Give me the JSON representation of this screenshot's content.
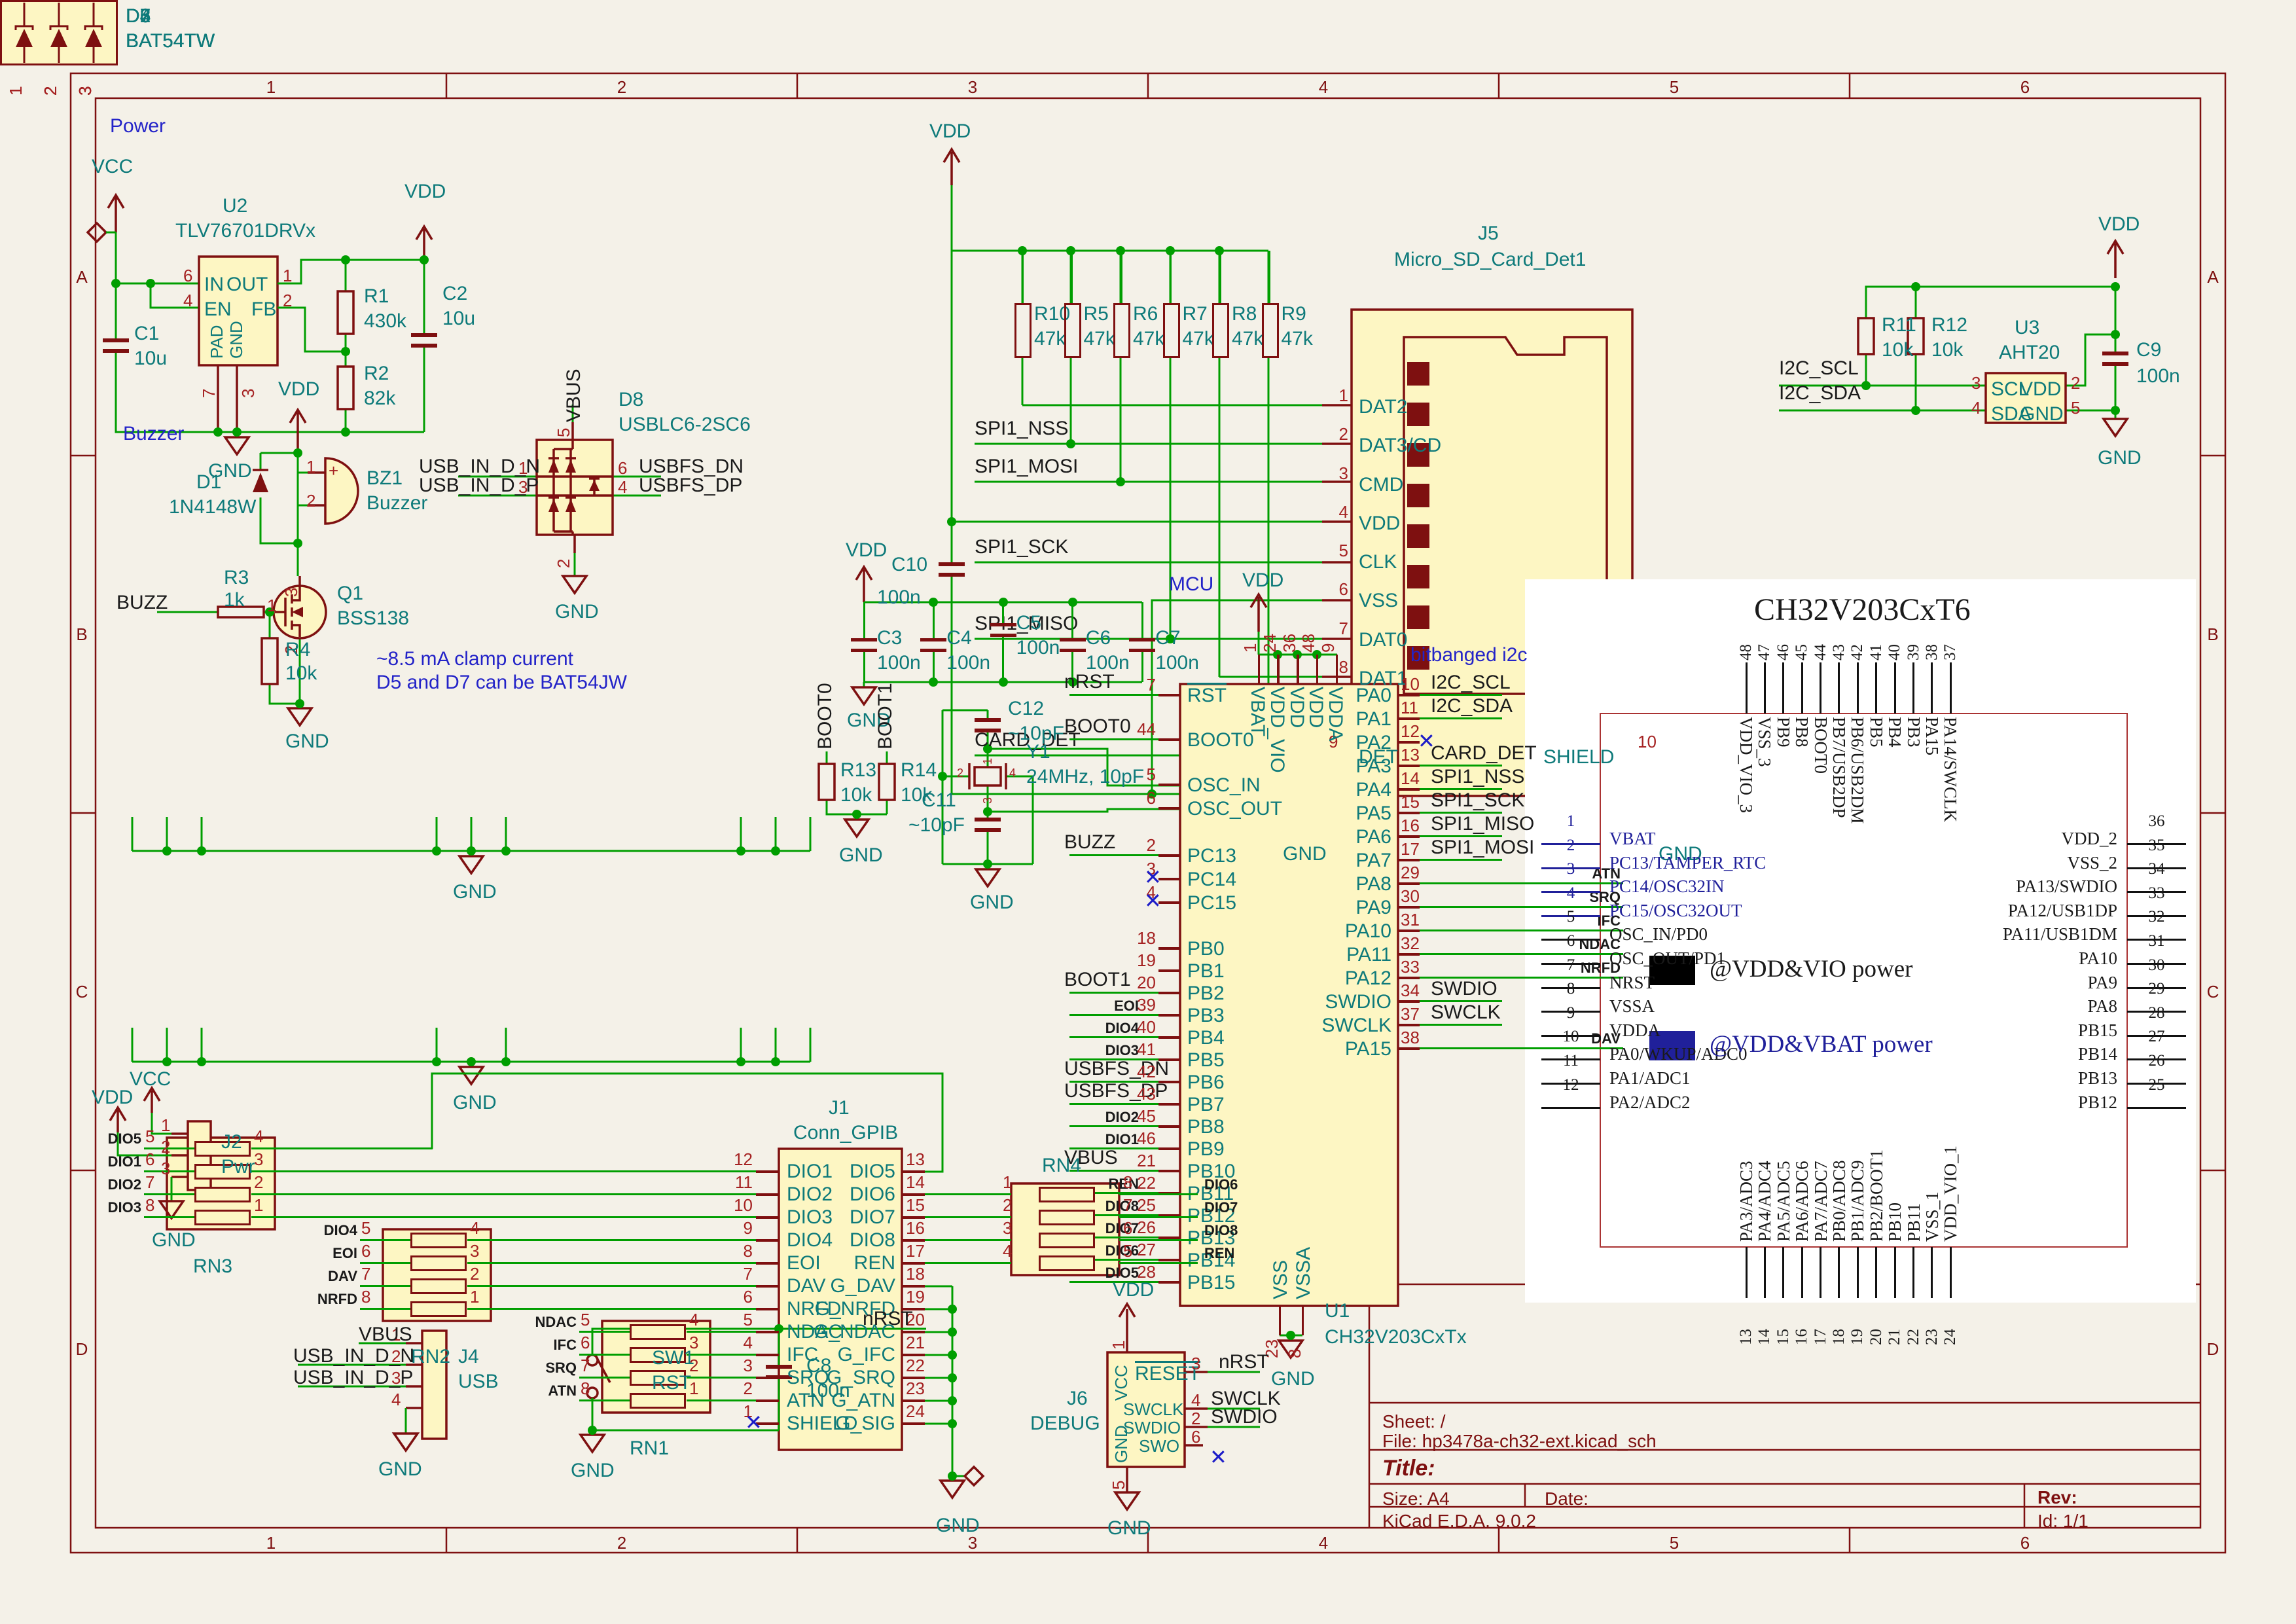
{
  "colors": {
    "background": "#F4F1E8",
    "wire_green": "#009E00",
    "symbol_dark_red": "#7E1010",
    "field_teal": "#0E7A7A",
    "note_blue": "#2323C8",
    "pin_number_red": "#A52222",
    "body_yellow": "#FDF6C3",
    "vbat_navy": "#20209A"
  },
  "frame": {
    "columns": [
      "1",
      "2",
      "3",
      "4",
      "5",
      "6"
    ],
    "rows": [
      "A",
      "B",
      "C",
      "D"
    ]
  },
  "title_block": {
    "sheet": "Sheet: /",
    "file": "File: hp3478a-ch32-ext.kicad_sch",
    "title": "Title:",
    "size": "Size: A4",
    "date": "Date:",
    "rev": "Rev:",
    "tool": "KiCad E.D.A. 9.0.2",
    "id": "Id: 1/1"
  },
  "notes": {
    "power": "Power",
    "buzzer": "Buzzer",
    "mcu": "MCU",
    "bitbanged": "bitbanged i2c",
    "clamp_1": "~8.5 mA clamp current",
    "clamp_2": "D5 and D7 can be BAT54JW"
  },
  "power_section": {
    "vcc": "VCC",
    "vdd_out": "VDD",
    "gnd": "GND",
    "u2": {
      "ref": "U2",
      "value": "TLV76701DRVx",
      "in_num": "6",
      "in_name": "IN",
      "en_num": "4",
      "en_name": "EN",
      "out_num": "1",
      "out_name": "OUT",
      "fb_num": "2",
      "fb_name": "FB",
      "pad_num": "7",
      "pad_name": "PAD",
      "gnd_num": "3",
      "gnd_name": "GND"
    },
    "c1_ref": "C1",
    "c1_val": "10u",
    "c2_ref": "C2",
    "c2_val": "10u",
    "r1_ref": "R1",
    "r1_val": "430k",
    "r2_ref": "R2",
    "r2_val": "82k"
  },
  "buzzer_section": {
    "vdd": "VDD",
    "gnd": "GND",
    "buzz": "BUZZ",
    "plus": "+",
    "d1_ref": "D1",
    "d1_val": "1N4148W",
    "bz1_ref": "BZ1",
    "bz1_val": "Buzzer",
    "bz1_p1": "1",
    "bz1_p2": "2",
    "q1_ref": "Q1",
    "q1_val": "BSS138",
    "q1_d": "3",
    "q1_g": "1",
    "q1_s": "2",
    "r3_ref": "R3",
    "r3_val": "1k",
    "r4_ref": "R4",
    "r4_val": "10k"
  },
  "d8_section": {
    "ref": "D8",
    "value": "USBLC6-2SC6",
    "vbus": "VBUS",
    "gnd": "GND",
    "p1": "1",
    "p3": "3",
    "p6": "6",
    "p4": "4",
    "p5": "5",
    "p2": "2",
    "in_dn": "USB_IN_D_N",
    "in_dp": "USB_IN_D_P",
    "out_dn": "USBFS_DN",
    "out_dp": "USBFS_DP"
  },
  "diode_bottom_nums": [
    "1",
    "2",
    "3"
  ],
  "diode_gnd": "GND",
  "diode_arrays": [
    {
      "ref": "D2",
      "value": "BAT54TW",
      "top": [
        {
          "num": "6",
          "label": "IFC"
        },
        {
          "num": "5",
          "label": "SRQ"
        },
        {
          "num": "4",
          "label": "ATN"
        }
      ]
    },
    {
      "ref": "D3",
      "value": "BAT54TW",
      "top": [
        {
          "num": "6",
          "label": "DAV"
        },
        {
          "num": "5",
          "label": "NRFD"
        },
        {
          "num": "4",
          "label": "NDAC"
        }
      ]
    },
    {
      "ref": "D4",
      "value": "BAT54TW",
      "top": [
        {
          "num": "6",
          "label": "DIO3"
        },
        {
          "num": "5",
          "label": "DIO4"
        },
        {
          "num": "4",
          "label": "EOI"
        }
      ]
    },
    {
      "ref": "D5",
      "value": "BAT54TW",
      "top": [
        {
          "num": "6",
          "label": "DIO1"
        },
        {
          "num": "5",
          "label": "",
          "kind": "nc"
        },
        {
          "num": "4",
          "label": "DIO2"
        }
      ]
    },
    {
      "ref": "D6",
      "value": "BAT54TW",
      "top": [
        {
          "num": "6",
          "label": "DIO5"
        },
        {
          "num": "5",
          "label": "DIO6"
        },
        {
          "num": "4",
          "label": "DIO7"
        }
      ]
    },
    {
      "ref": "D7",
      "value": "BAT54TW",
      "top": [
        {
          "num": "6",
          "label": "DIO8"
        },
        {
          "num": "5",
          "label": "",
          "kind": "nc"
        },
        {
          "num": "4",
          "label": "REN"
        }
      ]
    }
  ],
  "sd_section": {
    "vdd": "VDD",
    "gnd": "GND",
    "gnd_shield": "GND",
    "j5": {
      "ref": "J5",
      "value": "Micro_SD_Card_Det1",
      "pins": [
        {
          "num": "1",
          "name": "DAT2"
        },
        {
          "num": "2",
          "name": "DAT3/CD"
        },
        {
          "num": "3",
          "name": "CMD"
        },
        {
          "num": "4",
          "name": "VDD"
        },
        {
          "num": "5",
          "name": "CLK"
        },
        {
          "num": "6",
          "name": "VSS"
        },
        {
          "num": "7",
          "name": "DAT0"
        },
        {
          "num": "8",
          "name": "DAT1"
        }
      ],
      "det_num": "9",
      "det_name": "DET",
      "shield_num": "10",
      "shield_name": "SHIELD"
    },
    "pullups": [
      {
        "ref": "R10",
        "val": "47k"
      },
      {
        "ref": "R5",
        "val": "47k"
      },
      {
        "ref": "R6",
        "val": "47k"
      },
      {
        "ref": "R7",
        "val": "47k"
      },
      {
        "ref": "R8",
        "val": "47k"
      },
      {
        "ref": "R9",
        "val": "47k"
      }
    ],
    "c10_ref": "C10",
    "c10_val": "100n",
    "spi1_nss": "SPI1_NSS",
    "spi1_mosi": "SPI1_MOSI",
    "spi1_sck": "SPI1_SCK",
    "spi1_miso": "SPI1_MISO",
    "card_det": "CARD_DET"
  },
  "aht_section": {
    "vdd": "VDD",
    "gnd": "GND",
    "i2c_scl": "I2C_SCL",
    "i2c_sda": "I2C_SDA",
    "u3": {
      "ref": "U3",
      "value": "AHT20",
      "scl_num": "3",
      "scl": "SCL",
      "sda_num": "4",
      "sda": "SDA",
      "vdd_num": "2",
      "vdd": "VDD",
      "gnd_num": "5",
      "gnd": "GND"
    },
    "r11_ref": "R11",
    "r11_val": "10k",
    "r12_ref": "R12",
    "r12_val": "10k",
    "c9_ref": "C9",
    "c9_val": "100n"
  },
  "mcu_section": {
    "vdd_caps": "VDD",
    "gnd_caps": "GND",
    "vdd_top": "VDD",
    "gnd_bot": "GND",
    "u1": {
      "ref": "U1",
      "value": "CH32V203CxTx"
    },
    "caps": [
      {
        "ref": "C3",
        "val": "100n"
      },
      {
        "ref": "C4",
        "val": "100n"
      },
      {
        "ref": "C5",
        "val": "100n"
      },
      {
        "ref": "C6",
        "val": "100n"
      },
      {
        "ref": "C7",
        "val": "100n"
      }
    ],
    "top_pins": [
      {
        "num": "1",
        "name": "VBAT"
      },
      {
        "num": "24",
        "name": "VDD_VIO"
      },
      {
        "num": "36",
        "name": "VDD"
      },
      {
        "num": "48",
        "name": "VDD"
      },
      {
        "num": "9",
        "name": "VDDA"
      }
    ],
    "bottom_pins": [
      {
        "num": "23",
        "name": "VSS"
      },
      {
        "num": "8",
        "name": "VSSA"
      }
    ],
    "left_g1": [
      {
        "num": "7",
        "name": "RST",
        "net": "nRST",
        "kind": "global",
        "bar": "y"
      }
    ],
    "left_g2": [
      {
        "num": "44",
        "name": "BOOT0",
        "net": "BOOT0",
        "kind": "global"
      }
    ],
    "left_g3": [
      {
        "num": "5",
        "name": "OSC_IN",
        "kind": "wire"
      },
      {
        "num": "6",
        "name": "OSC_OUT",
        "kind": "wire"
      }
    ],
    "left_g4": [
      {
        "num": "2",
        "name": "PC13",
        "net": "BUZZ",
        "kind": "global"
      },
      {
        "num": "3",
        "name": "PC14",
        "kind": "nc"
      },
      {
        "num": "4",
        "name": "PC15",
        "kind": "nc"
      }
    ],
    "left_g5": [
      {
        "num": "18",
        "name": "PB0",
        "kind": "none"
      },
      {
        "num": "19",
        "name": "PB1",
        "kind": "none"
      },
      {
        "num": "20",
        "name": "PB2",
        "net": "BOOT1",
        "kind": "global"
      },
      {
        "num": "39",
        "name": "PB3",
        "net": "EOI",
        "kind": "small"
      },
      {
        "num": "40",
        "name": "PB4",
        "net": "DIO4",
        "kind": "small"
      },
      {
        "num": "41",
        "name": "PB5",
        "net": "DIO3",
        "kind": "small"
      },
      {
        "num": "42",
        "name": "PB6",
        "net": "USBFS_DN",
        "kind": "global"
      },
      {
        "num": "43",
        "name": "PB7",
        "net": "USBFS_DP",
        "kind": "global"
      },
      {
        "num": "45",
        "name": "PB8",
        "net": "DIO2",
        "kind": "small"
      },
      {
        "num": "46",
        "name": "PB9",
        "net": "DIO1",
        "kind": "small"
      },
      {
        "num": "21",
        "name": "PB10",
        "net": "VBUS",
        "kind": "global"
      },
      {
        "num": "22",
        "name": "PB11",
        "net": "REN",
        "kind": "small"
      },
      {
        "num": "25",
        "name": "PB12",
        "net": "DIO8",
        "kind": "small"
      },
      {
        "num": "26",
        "name": "PB13",
        "net": "DIO7",
        "kind": "small"
      },
      {
        "num": "27",
        "name": "PB14",
        "net": "DIO6",
        "kind": "small"
      },
      {
        "num": "28",
        "name": "PB15",
        "net": "DIO5",
        "kind": "small"
      }
    ],
    "right_pins": [
      {
        "num": "10",
        "name": "PA0",
        "net": "I2C_SCL",
        "kind": "global"
      },
      {
        "num": "11",
        "name": "PA1",
        "net": "I2C_SDA",
        "kind": "global"
      },
      {
        "num": "12",
        "name": "PA2",
        "kind": "nc"
      },
      {
        "num": "13",
        "name": "PA3",
        "net": "CARD_DET",
        "kind": "global"
      },
      {
        "num": "14",
        "name": "PA4",
        "net": "SPI1_NSS",
        "kind": "global"
      },
      {
        "num": "15",
        "name": "PA5",
        "net": "SPI1_SCK",
        "kind": "global"
      },
      {
        "num": "16",
        "name": "PA6",
        "net": "SPI1_MISO",
        "kind": "global"
      },
      {
        "num": "17",
        "name": "PA7",
        "net": "SPI1_MOSI",
        "kind": "global"
      },
      {
        "num": "29",
        "name": "PA8",
        "net": "ATN",
        "kind": "small"
      },
      {
        "num": "30",
        "name": "PA9",
        "net": "SRQ",
        "kind": "small"
      },
      {
        "num": "31",
        "name": "PA10",
        "net": "IFC",
        "kind": "small"
      },
      {
        "num": "32",
        "name": "PA11",
        "net": "NDAC",
        "kind": "small"
      },
      {
        "num": "33",
        "name": "PA12",
        "net": "NRFD",
        "kind": "small"
      },
      {
        "num": "34",
        "name": "SWDIO",
        "net": "SWDIO",
        "kind": "global"
      },
      {
        "num": "37",
        "name": "SWCLK",
        "net": "SWCLK",
        "kind": "global"
      },
      {
        "num": "38",
        "name": "PA15",
        "net": "DAV",
        "kind": "small"
      }
    ],
    "xtal": {
      "y1_ref": "Y1",
      "y1_val": "24MHz, 10pF",
      "c11_ref": "C11",
      "c11_val": "~10pF",
      "c12_ref": "C12",
      "c12_val": "~10pF",
      "gnd": "GND",
      "p1": "1",
      "p2": "2",
      "p3": "3",
      "p4": "4"
    },
    "boot": {
      "boot0": "BOOT0",
      "boot1": "BOOT1",
      "r13_ref": "R13",
      "r13_val": "10k",
      "r14_ref": "R14",
      "r14_val": "10k",
      "gnd": "GND"
    }
  },
  "gpib_section": {
    "gnd": "GND",
    "j1": {
      "ref": "J1",
      "value": "Conn_GPIB",
      "left": [
        {
          "num": "12",
          "name": "DIO1"
        },
        {
          "num": "11",
          "name": "DIO2"
        },
        {
          "num": "10",
          "name": "DIO3"
        },
        {
          "num": "9",
          "name": "DIO4"
        },
        {
          "num": "8",
          "name": "EOI"
        },
        {
          "num": "7",
          "name": "DAV"
        },
        {
          "num": "6",
          "name": "NRFD"
        },
        {
          "num": "5",
          "name": "NDAC"
        },
        {
          "num": "4",
          "name": "IFC"
        },
        {
          "num": "3",
          "name": "SRQ"
        },
        {
          "num": "2",
          "name": "ATN"
        },
        {
          "num": "1",
          "name": "SHIELD",
          "kind": "nc"
        }
      ],
      "right": [
        {
          "num": "13",
          "name": "DIO5"
        },
        {
          "num": "14",
          "name": "DIO6"
        },
        {
          "num": "15",
          "name": "DIO7"
        },
        {
          "num": "16",
          "name": "DIO8"
        },
        {
          "num": "17",
          "name": "REN"
        },
        {
          "num": "18",
          "name": "G_DAV"
        },
        {
          "num": "19",
          "name": "G_NRFD"
        },
        {
          "num": "20",
          "name": "G_NDAC"
        },
        {
          "num": "21",
          "name": "G_IFC"
        },
        {
          "num": "22",
          "name": "G_SRQ"
        },
        {
          "num": "23",
          "name": "G_ATN"
        },
        {
          "num": "24",
          "name": "G_SIG"
        }
      ]
    },
    "rn3_ref": "RN3",
    "rn2_ref": "RN2",
    "rn1_ref": "RN1",
    "rn4_ref": "RN4",
    "rn3": [
      {
        "ln": "5",
        "label": "DIO5",
        "rn": "4"
      },
      {
        "ln": "6",
        "label": "DIO1",
        "rn": "3"
      },
      {
        "ln": "7",
        "label": "DIO2",
        "rn": "2"
      },
      {
        "ln": "8",
        "label": "DIO3",
        "rn": "1"
      }
    ],
    "rn2": [
      {
        "ln": "5",
        "label": "DIO4",
        "rn": "4"
      },
      {
        "ln": "6",
        "label": "EOI",
        "rn": "3"
      },
      {
        "ln": "7",
        "label": "DAV",
        "rn": "2"
      },
      {
        "ln": "8",
        "label": "NRFD",
        "rn": "1"
      }
    ],
    "rn1": [
      {
        "ln": "5",
        "label": "NDAC",
        "rn": "4"
      },
      {
        "ln": "6",
        "label": "IFC",
        "rn": "3"
      },
      {
        "ln": "7",
        "label": "SRQ",
        "rn": "2"
      },
      {
        "ln": "8",
        "label": "ATN",
        "rn": "1"
      }
    ],
    "rn4": [
      {
        "ln": "1",
        "label": "DIO6",
        "rn": "8"
      },
      {
        "ln": "2",
        "label": "DIO7",
        "rn": "7"
      },
      {
        "ln": "3",
        "label": "DIO8",
        "rn": "6"
      },
      {
        "ln": "4",
        "label": "REN",
        "rn": "5"
      }
    ]
  },
  "conn_section": {
    "vcc": "VCC",
    "vdd": "VDD",
    "gnd_j2": "GND",
    "gnd_j4": "GND",
    "gnd_sw": "GND",
    "nrst": "nRST",
    "j2": {
      "ref": "J2",
      "value": "Pwr",
      "p1": "1",
      "p2": "2",
      "p3": "3"
    },
    "j4": {
      "ref": "J4",
      "value": "USB",
      "p1": "1",
      "p2": "2",
      "p3": "3",
      "p4": "4",
      "vbus": "VBUS",
      "dn": "USB_IN_D_N",
      "dp": "USB_IN_D_P"
    },
    "sw1_ref": "SW1",
    "sw1_val": "RST",
    "c8_ref": "C8",
    "c8_val": "100n"
  },
  "debug_section": {
    "vdd": "VDD",
    "gnd": "GND",
    "nrst": "nRST",
    "swclk": "SWCLK",
    "swdio": "SWDIO",
    "j6": {
      "ref": "J6",
      "value": "DEBUG",
      "vcc": "VCC",
      "reset": "RESET",
      "swclk": "SWCLK",
      "swdio": "SWDIO",
      "swo": "SWO",
      "gnd": "GND",
      "p1": "1",
      "p3": "3",
      "p4": "4",
      "p2": "2",
      "p6": "6",
      "p5": "5"
    }
  },
  "pinout": {
    "title": "CH32V203CxT6",
    "legend_vio": "@VDD&VIO power",
    "legend_vbat": "@VDD&VBAT power",
    "top": [
      {
        "num": "48",
        "name": "VDD_VIO_3"
      },
      {
        "num": "47",
        "name": "VSS_3"
      },
      {
        "num": "46",
        "name": "PB9"
      },
      {
        "num": "45",
        "name": "PB8"
      },
      {
        "num": "44",
        "name": "BOOT0"
      },
      {
        "num": "43",
        "name": "PB7/USB2DP"
      },
      {
        "num": "42",
        "name": "PB6/USB2DM"
      },
      {
        "num": "41",
        "name": "PB5"
      },
      {
        "num": "40",
        "name": "PB4"
      },
      {
        "num": "39",
        "name": "PB3"
      },
      {
        "num": "38",
        "name": "PA15"
      },
      {
        "num": "37",
        "name": "PA14/SWCLK"
      }
    ],
    "left": [
      {
        "num": "1",
        "name": "VBAT",
        "domain": "vbat"
      },
      {
        "num": "2",
        "name": "PC13/TAMPER_RTC",
        "domain": "vbat"
      },
      {
        "num": "3",
        "name": "PC14/OSC32IN",
        "domain": "vbat"
      },
      {
        "num": "4",
        "name": "PC15/OSC32OUT",
        "domain": "vbat"
      },
      {
        "num": "5",
        "name": "OSC_IN/PD0"
      },
      {
        "num": "6",
        "name": "OSC_OUT/PD1"
      },
      {
        "num": "7",
        "name": "NRST"
      },
      {
        "num": "8",
        "name": "VSSA"
      },
      {
        "num": "9",
        "name": "VDDA"
      },
      {
        "num": "10",
        "name": "PA0/WKUP/ADC0"
      },
      {
        "num": "11",
        "name": "PA1/ADC1"
      },
      {
        "num": "12",
        "name": "PA2/ADC2"
      }
    ],
    "right": [
      {
        "num": "36",
        "name": "VDD_2"
      },
      {
        "num": "35",
        "name": "VSS_2"
      },
      {
        "num": "34",
        "name": "PA13/SWDIO"
      },
      {
        "num": "33",
        "name": "PA12/USB1DP"
      },
      {
        "num": "32",
        "name": "PA11/USB1DM"
      },
      {
        "num": "31",
        "name": "PA10"
      },
      {
        "num": "30",
        "name": "PA9"
      },
      {
        "num": "29",
        "name": "PA8"
      },
      {
        "num": "28",
        "name": "PB15"
      },
      {
        "num": "27",
        "name": "PB14"
      },
      {
        "num": "26",
        "name": "PB13"
      },
      {
        "num": "25",
        "name": "PB12"
      }
    ],
    "bottom": [
      {
        "num": "13",
        "name": "PA3/ADC3"
      },
      {
        "num": "14",
        "name": "PA4/ADC4"
      },
      {
        "num": "15",
        "name": "PA5/ADC5"
      },
      {
        "num": "16",
        "name": "PA6/ADC6"
      },
      {
        "num": "17",
        "name": "PA7/ADC7"
      },
      {
        "num": "18",
        "name": "PB0/ADC8"
      },
      {
        "num": "19",
        "name": "PB1/ADC9"
      },
      {
        "num": "20",
        "name": "PB2/BOOT1"
      },
      {
        "num": "21",
        "name": "PB10"
      },
      {
        "num": "22",
        "name": "PB11"
      },
      {
        "num": "23",
        "name": "VSS_1"
      },
      {
        "num": "24",
        "name": "VDD_VIO_1"
      }
    ]
  }
}
